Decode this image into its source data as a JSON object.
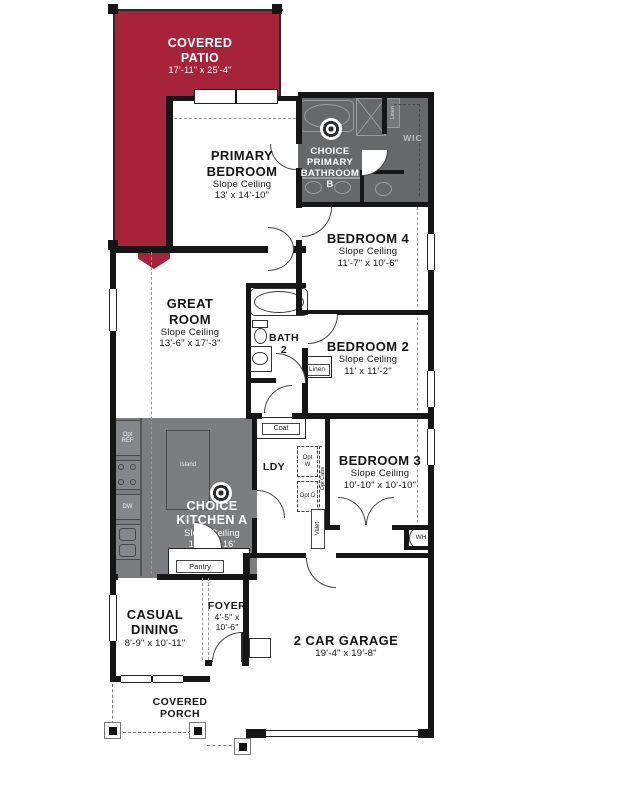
{
  "colors": {
    "patio": "#a62339",
    "bath": "#67686a",
    "kitchen": "#7c7d7f",
    "wall": "#161616"
  },
  "rooms": {
    "covered_patio": {
      "name": "COVERED PATIO",
      "dim": "17'-11\" x 25'-4\""
    },
    "primary_bedroom": {
      "name": "PRIMARY BEDROOM",
      "sub": "Slope Ceiling",
      "dim": "13' x 14'-10\""
    },
    "primary_bath": {
      "name": "CHOICE PRIMARY BATHROOM B"
    },
    "bedroom4": {
      "name": "BEDROOM 4",
      "sub": "Slope Ceiling",
      "dim": "11'-7\" x 10'-6\""
    },
    "great_room": {
      "name": "GREAT ROOM",
      "sub": "Slope Ceiling",
      "dim": "13'-6\" x 17'-3\""
    },
    "bath2": {
      "name": "BATH 2"
    },
    "bedroom2": {
      "name": "BEDROOM 2",
      "sub": "Slope Ceiling",
      "dim": "11' x 11'-2\""
    },
    "kitchen": {
      "name": "CHOICE KITCHEN A",
      "sub": "Slope Ceiling",
      "dim": "14'-2\" x 16'"
    },
    "ldy": {
      "name": "LDY"
    },
    "bedroom3": {
      "name": "BEDROOM 3",
      "sub": "Slope Ceiling",
      "dim": "10'-10\" x 10'-10\""
    },
    "casual_dining": {
      "name": "CASUAL DINING",
      "dim": "8'-9\" x 10'-11\""
    },
    "foyer": {
      "name": "FOYER",
      "dim": "4'-5\" x 10'-6\""
    },
    "garage": {
      "name": "2 CAR GARAGE",
      "dim": "19'-4\" x 19'-8\""
    },
    "porch": {
      "name": "COVERED PORCH"
    }
  },
  "labels": {
    "wic": "WIC",
    "linen_bath": "Linen",
    "linen_hall": "Linen",
    "coat": "Coat",
    "opt_ref": "Opt REF",
    "dw": "DW",
    "island": "Island",
    "pantry": "Pantry",
    "opt_w": "Opt W",
    "opt_d": "Opt D",
    "opt_cabs": "Opt Cabs",
    "valet": "Valet",
    "wh": "WH"
  }
}
